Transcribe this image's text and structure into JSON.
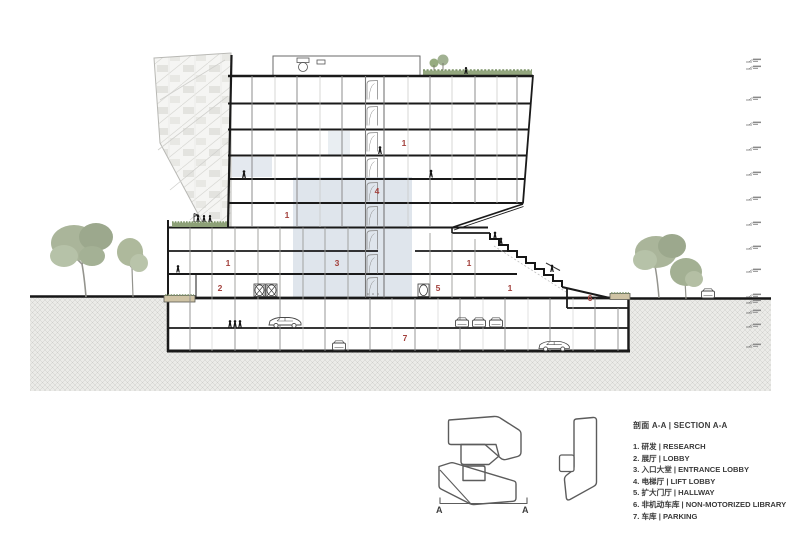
{
  "drawing": {
    "type": "architectural-section",
    "section_line_label_left": "A",
    "section_line_label_right": "A"
  },
  "legend": {
    "title": "剖面 A-A | SECTION A-A",
    "items": [
      {
        "num": "1",
        "zh": "研发",
        "en": "RESEARCH",
        "text": "1. 研发 | RESEARCH"
      },
      {
        "num": "2",
        "zh": "展厅",
        "en": "LOBBY",
        "text": "2. 展厅 | LOBBY"
      },
      {
        "num": "3",
        "zh": "入口大堂",
        "en": "ENTRANCE LOBBY",
        "text": "3. 入口大堂 | ENTRANCE LOBBY"
      },
      {
        "num": "4",
        "zh": "电梯厅",
        "en": "LIFT LOBBY",
        "text": "4. 电梯厅 | LIFT LOBBY"
      },
      {
        "num": "5",
        "zh": "扩大门厅",
        "en": "HALLWAY",
        "text": "5. 扩大门厅 | HALLWAY"
      },
      {
        "num": "6",
        "zh": "非机动车库",
        "en": "NON-MOTORIZED LIBRARY",
        "text": "6. 非机动车库 | NON-MOTORIZED LIBRARY"
      },
      {
        "num": "7",
        "zh": "车库",
        "en": "PARKING",
        "text": "7. 车库 | PARKING"
      }
    ]
  },
  "markers": {
    "research_top": "1",
    "lift_lobby": "4",
    "research_mid": "1",
    "research_wing": "1",
    "lobby": "2",
    "entrance_lobby": "3",
    "research_right": "1",
    "hallway": "5",
    "research_right_low": "1",
    "non_motorized": "6",
    "parking": "7"
  },
  "colors": {
    "marker_red": "#a3413c",
    "atrium_blue": "#dbe2ea",
    "roof_green": "#8da077",
    "ground_hatch": "#ebebe8",
    "line_dark": "#1a1a1a"
  }
}
